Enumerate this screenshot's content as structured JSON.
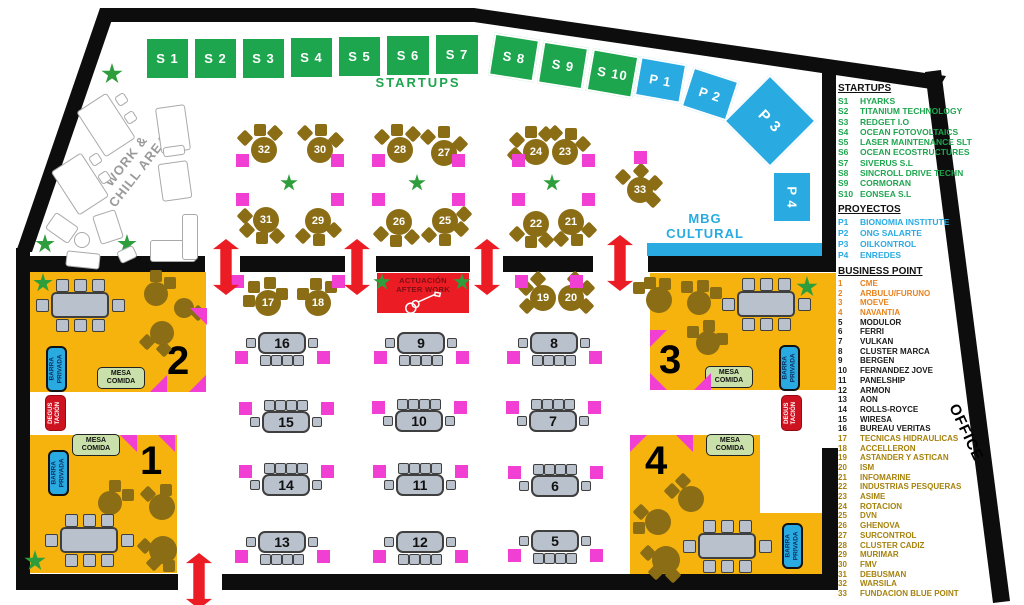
{
  "labels": {
    "startups_banner": "STARTUPS",
    "work_chill": "WORK &\nCHILL AREA",
    "mbg": "MBG\nCULTURAL",
    "office": "OFFICE",
    "stage": "ACTUACIÓN\nAFTER WORK",
    "barra": "BARRA\nPRIVADA",
    "mesa": "MESA\nCOMIDA",
    "degustacion": "DEGUS\nTACIÓN",
    "z1": "1",
    "z2": "2",
    "z3": "3",
    "z4": "4"
  },
  "colors": {
    "startup_green": "#1EA64F",
    "proyecto_blue": "#29ABE2",
    "zone_yellow": "#F6B30D",
    "marker_pink": "#F13FD3",
    "entrance_red": "#EC1C24",
    "table_brown": "#8A6D15",
    "table_gray": "#B9C1CC",
    "business_orange": "#E8821C",
    "business_olive": "#A6820C",
    "wall_black": "#0d0d0d"
  },
  "legend": {
    "startups": {
      "header": "STARTUPS",
      "items": [
        {
          "code": "S1",
          "name": "HYARKS",
          "c": "g"
        },
        {
          "code": "S2",
          "name": "TITANIUM TECHNOLOGY",
          "c": "g"
        },
        {
          "code": "S3",
          "name": "REDGET I.O",
          "c": "g"
        },
        {
          "code": "S4",
          "name": "OCEAN FOTOVOLTAICS",
          "c": "g"
        },
        {
          "code": "S5",
          "name": "LASER MAINTENANCE SLT",
          "c": "g"
        },
        {
          "code": "S6",
          "name": "OCEAN ECOSTRUCTURES",
          "c": "g"
        },
        {
          "code": "S7",
          "name": "SIVERUS S.L",
          "c": "g"
        },
        {
          "code": "S8",
          "name": "SINCROLL DRIVE TECHN",
          "c": "g"
        },
        {
          "code": "S9",
          "name": "CORMORAN",
          "c": "g"
        },
        {
          "code": "S10",
          "name": "EONSEA S.L",
          "c": "g"
        }
      ]
    },
    "proyectos": {
      "header": "PROYECTOS",
      "items": [
        {
          "code": "P1",
          "name": "BIONOMIA INSTITUTE",
          "c": "b"
        },
        {
          "code": "P2",
          "name": "ONG SALARTE",
          "c": "b"
        },
        {
          "code": "P3",
          "name": "OILKONTROL",
          "c": "b"
        },
        {
          "code": "P4",
          "name": "ENREDES",
          "c": "b"
        }
      ]
    },
    "business": {
      "header": "BUSINESS POINT",
      "items": [
        {
          "code": "1",
          "name": "CME",
          "c": "o"
        },
        {
          "code": "2",
          "name": "ARBULU/FURUNO",
          "c": "o"
        },
        {
          "code": "3",
          "name": "MOEVE",
          "c": "o"
        },
        {
          "code": "4",
          "name": "NAVANTIA",
          "c": "o"
        },
        {
          "code": "5",
          "name": "MODULOR",
          "c": "k"
        },
        {
          "code": "6",
          "name": "FERRI",
          "c": "k"
        },
        {
          "code": "7",
          "name": "VULKAN",
          "c": "k"
        },
        {
          "code": "8",
          "name": "CLUSTER MARCA",
          "c": "k"
        },
        {
          "code": "9",
          "name": "BERGEN",
          "c": "k"
        },
        {
          "code": "10",
          "name": "FERNANDEZ JOVE",
          "c": "k"
        },
        {
          "code": "11",
          "name": "PANELSHIP",
          "c": "k"
        },
        {
          "code": "12",
          "name": "ARMON",
          "c": "k"
        },
        {
          "code": "13",
          "name": "AON",
          "c": "k"
        },
        {
          "code": "14",
          "name": "ROLLS-ROYCE",
          "c": "k"
        },
        {
          "code": "15",
          "name": "WIRESA",
          "c": "k"
        },
        {
          "code": "16",
          "name": "BUREAU VERITAS",
          "c": "k"
        },
        {
          "code": "17",
          "name": "TECNICAS HIDRAULICAS",
          "c": "y"
        },
        {
          "code": "18",
          "name": "ACCELLERON",
          "c": "y"
        },
        {
          "code": "19",
          "name": "ASTANDER Y ASTICAN",
          "c": "y"
        },
        {
          "code": "20",
          "name": "ISM",
          "c": "y"
        },
        {
          "code": "21",
          "name": "INFOMARINE",
          "c": "y"
        },
        {
          "code": "22",
          "name": "INDUSTRIAS PESQUERAS",
          "c": "y"
        },
        {
          "code": "23",
          "name": "ASIME",
          "c": "y"
        },
        {
          "code": "24",
          "name": "ROTACION",
          "c": "y"
        },
        {
          "code": "25",
          "name": "DVN",
          "c": "y"
        },
        {
          "code": "26",
          "name": "GHENOVA",
          "c": "y"
        },
        {
          "code": "27",
          "name": "SURCONTROL",
          "c": "y"
        },
        {
          "code": "28",
          "name": "CLUSTER CADIZ",
          "c": "y"
        },
        {
          "code": "29",
          "name": "MURIMAR",
          "c": "y"
        },
        {
          "code": "30",
          "name": "FMV",
          "c": "y"
        },
        {
          "code": "31",
          "name": "DEBUSMAN",
          "c": "y"
        },
        {
          "code": "32",
          "name": "WARSILA",
          "c": "y"
        },
        {
          "code": "33",
          "name": "FUNDACION BLUE POINT",
          "c": "y"
        }
      ]
    }
  },
  "booths": {
    "startups": [
      {
        "label": "S 1",
        "x": 145,
        "y": 37,
        "w": 45,
        "h": 43,
        "rot": 0
      },
      {
        "label": "S 2",
        "x": 193,
        "y": 37,
        "w": 45,
        "h": 43,
        "rot": 0
      },
      {
        "label": "S 3",
        "x": 241,
        "y": 37,
        "w": 45,
        "h": 43,
        "rot": 0
      },
      {
        "label": "S 4",
        "x": 289,
        "y": 36,
        "w": 45,
        "h": 43,
        "rot": 0
      },
      {
        "label": "S 5",
        "x": 337,
        "y": 35,
        "w": 45,
        "h": 43,
        "rot": 0
      },
      {
        "label": "S 6",
        "x": 385,
        "y": 34,
        "w": 46,
        "h": 43,
        "rot": 0
      },
      {
        "label": "S 7",
        "x": 434,
        "y": 33,
        "w": 46,
        "h": 43,
        "rot": 0
      },
      {
        "label": "S 8",
        "x": 491,
        "y": 36,
        "w": 46,
        "h": 43,
        "rot": 9
      },
      {
        "label": "S 9",
        "x": 540,
        "y": 44,
        "w": 46,
        "h": 43,
        "rot": 9
      },
      {
        "label": "S 10",
        "x": 589,
        "y": 52,
        "w": 47,
        "h": 43,
        "rot": 10
      }
    ],
    "proyectos": [
      {
        "label": "P 1",
        "x": 637,
        "y": 60,
        "w": 47,
        "h": 40,
        "rot": 10
      },
      {
        "label": "P 2",
        "x": 686,
        "y": 73,
        "w": 48,
        "h": 42,
        "rot": 18
      },
      {
        "label": "P 3",
        "x": 737,
        "y": 88,
        "w": 66,
        "h": 66,
        "rot": 45,
        "fs": 15
      },
      {
        "label": "P 4",
        "x": 772,
        "y": 171,
        "w": 40,
        "h": 52,
        "rot": 0,
        "vert": true
      }
    ]
  },
  "round_tables": [
    {
      "n": "32",
      "x": 264,
      "y": 150,
      "ch": [
        [
          -19,
          -12,
          45
        ],
        [
          -4,
          -20,
          0
        ],
        [
          11,
          -17,
          45
        ]
      ]
    },
    {
      "n": "30",
      "x": 320,
      "y": 150,
      "ch": [
        [
          -15,
          -17,
          45
        ],
        [
          1,
          -20,
          0
        ],
        [
          16,
          -10,
          45
        ]
      ]
    },
    {
      "n": "28",
      "x": 400,
      "y": 150,
      "ch": [
        [
          -18,
          -13,
          45
        ],
        [
          -3,
          -20,
          0
        ],
        [
          13,
          -16,
          45
        ]
      ]
    },
    {
      "n": "27",
      "x": 444,
      "y": 153,
      "ch": [
        [
          -16,
          -16,
          45
        ],
        [
          0,
          -21,
          0
        ],
        [
          16,
          -9,
          45
        ]
      ]
    },
    {
      "n": "24",
      "x": 536,
      "y": 152,
      "ch": [
        [
          -19,
          -12,
          45
        ],
        [
          -5,
          -20,
          0
        ],
        [
          10,
          -18,
          45
        ],
        [
          -21,
          3,
          45
        ]
      ]
    },
    {
      "n": "23",
      "x": 565,
      "y": 152,
      "ch": [
        [
          -10,
          -19,
          45
        ],
        [
          6,
          -18,
          0
        ],
        [
          18,
          -8,
          45
        ]
      ]
    },
    {
      "n": "31",
      "x": 266,
      "y": 220,
      "ch": [
        [
          -19,
          10,
          45
        ],
        [
          -4,
          18,
          0
        ],
        [
          11,
          16,
          45
        ],
        [
          -21,
          -4,
          45
        ]
      ]
    },
    {
      "n": "29",
      "x": 318,
      "y": 221,
      "ch": [
        [
          -15,
          15,
          45
        ],
        [
          1,
          19,
          0
        ],
        [
          16,
          9,
          45
        ]
      ]
    },
    {
      "n": "26",
      "x": 399,
      "y": 222,
      "ch": [
        [
          -18,
          12,
          45
        ],
        [
          -3,
          19,
          0
        ],
        [
          13,
          15,
          45
        ]
      ]
    },
    {
      "n": "25",
      "x": 445,
      "y": 221,
      "ch": [
        [
          -16,
          14,
          45
        ],
        [
          0,
          19,
          0
        ],
        [
          16,
          8,
          45
        ],
        [
          19,
          -7,
          45
        ]
      ]
    },
    {
      "n": "22",
      "x": 536,
      "y": 224,
      "ch": [
        [
          -19,
          10,
          45
        ],
        [
          -5,
          18,
          0
        ],
        [
          10,
          16,
          45
        ]
      ]
    },
    {
      "n": "21",
      "x": 571,
      "y": 222,
      "ch": [
        [
          -10,
          17,
          45
        ],
        [
          6,
          18,
          0
        ],
        [
          18,
          8,
          45
        ]
      ]
    },
    {
      "n": "33",
      "x": 640,
      "y": 190,
      "ch": [
        [
          -17,
          -13,
          45
        ],
        [
          1,
          -19,
          45
        ],
        [
          15,
          -7,
          45
        ],
        [
          13,
          10,
          45
        ]
      ]
    },
    {
      "n": "17",
      "x": 268,
      "y": 303,
      "ch": [
        [
          -14,
          -16,
          0
        ],
        [
          2,
          -20,
          0
        ],
        [
          -19,
          -2,
          0
        ],
        [
          14,
          -9,
          0
        ]
      ]
    },
    {
      "n": "18",
      "x": 318,
      "y": 303,
      "ch": [
        [
          -15,
          -9,
          0
        ],
        [
          -2,
          -19,
          0
        ],
        [
          13,
          -16,
          0
        ]
      ]
    },
    {
      "n": "19",
      "x": 543,
      "y": 298,
      "ch": [
        [
          -17,
          -10,
          45
        ],
        [
          -5,
          -19,
          45
        ],
        [
          -16,
          8,
          45
        ]
      ]
    },
    {
      "n": "20",
      "x": 571,
      "y": 298,
      "ch": [
        [
          16,
          -10,
          45
        ],
        [
          4,
          -19,
          45
        ],
        [
          15,
          8,
          45
        ]
      ]
    }
  ],
  "rect_tables": [
    {
      "n": "16",
      "x": 282,
      "y": 343,
      "side": "bottom"
    },
    {
      "n": "9",
      "x": 421,
      "y": 343,
      "side": "bottom"
    },
    {
      "n": "8",
      "x": 554,
      "y": 343,
      "side": "bottom"
    },
    {
      "n": "15",
      "x": 286,
      "y": 422,
      "side": "top"
    },
    {
      "n": "10",
      "x": 419,
      "y": 421,
      "side": "top"
    },
    {
      "n": "7",
      "x": 553,
      "y": 421,
      "side": "top"
    },
    {
      "n": "14",
      "x": 286,
      "y": 485,
      "side": "top"
    },
    {
      "n": "11",
      "x": 420,
      "y": 485,
      "side": "top"
    },
    {
      "n": "6",
      "x": 555,
      "y": 486,
      "side": "top"
    },
    {
      "n": "13",
      "x": 282,
      "y": 542,
      "side": "bottom"
    },
    {
      "n": "12",
      "x": 420,
      "y": 542,
      "side": "bottom"
    },
    {
      "n": "5",
      "x": 555,
      "y": 541,
      "side": "bottom"
    }
  ],
  "zone_round_tables": [
    {
      "x": 156,
      "y": 294,
      "d": 24,
      "ch": [
        [
          14,
          -11,
          0
        ],
        [
          0,
          -18,
          0
        ]
      ]
    },
    {
      "x": 184,
      "y": 308,
      "d": 20,
      "ch": [
        [
          14,
          5,
          45
        ]
      ]
    },
    {
      "x": 162,
      "y": 333,
      "d": 24,
      "ch": [
        [
          -15,
          9,
          45
        ],
        [
          2,
          16,
          45
        ]
      ]
    },
    {
      "x": 110,
      "y": 503,
      "d": 24,
      "ch": [
        [
          5,
          -17,
          0
        ],
        [
          18,
          -8,
          0
        ]
      ]
    },
    {
      "x": 162,
      "y": 507,
      "d": 26,
      "ch": [
        [
          -14,
          -13,
          45
        ],
        [
          4,
          -17,
          0
        ]
      ]
    },
    {
      "x": 163,
      "y": 550,
      "d": 28,
      "ch": [
        [
          -18,
          -4,
          45
        ],
        [
          -9,
          13,
          45
        ],
        [
          6,
          16,
          0
        ]
      ]
    },
    {
      "x": 659,
      "y": 300,
      "d": 26,
      "ch": [
        [
          -9,
          -17,
          0
        ],
        [
          6,
          -16,
          0
        ],
        [
          -20,
          -12,
          0
        ]
      ]
    },
    {
      "x": 699,
      "y": 303,
      "d": 24,
      "ch": [
        [
          -12,
          -16,
          0
        ],
        [
          4,
          -17,
          0
        ],
        [
          17,
          -10,
          0
        ]
      ]
    },
    {
      "x": 708,
      "y": 343,
      "d": 24,
      "ch": [
        [
          -15,
          -11,
          0
        ],
        [
          1,
          -17,
          0
        ],
        [
          14,
          -4,
          0
        ]
      ]
    },
    {
      "x": 691,
      "y": 499,
      "d": 26,
      "ch": [
        [
          -8,
          -18,
          45
        ],
        [
          -19,
          -8,
          45
        ]
      ]
    },
    {
      "x": 658,
      "y": 522,
      "d": 26,
      "ch": [
        [
          -17,
          -10,
          45
        ],
        [
          -19,
          6,
          0
        ]
      ]
    },
    {
      "x": 666,
      "y": 560,
      "d": 28,
      "ch": [
        [
          -18,
          -7,
          45
        ],
        [
          -10,
          12,
          45
        ],
        [
          7,
          15,
          45
        ]
      ]
    }
  ],
  "zone_rect_tables": [
    {
      "x": 80,
      "y": 305
    },
    {
      "x": 89,
      "y": 540
    },
    {
      "x": 766,
      "y": 304
    },
    {
      "x": 727,
      "y": 546
    }
  ],
  "pink_squares": [
    [
      242,
      160
    ],
    [
      337,
      160
    ],
    [
      242,
      199
    ],
    [
      337,
      199
    ],
    [
      378,
      160
    ],
    [
      458,
      160
    ],
    [
      378,
      199
    ],
    [
      458,
      199
    ],
    [
      518,
      160
    ],
    [
      588,
      160
    ],
    [
      518,
      199
    ],
    [
      588,
      199
    ],
    [
      640,
      157
    ],
    [
      237,
      281
    ],
    [
      338,
      281
    ],
    [
      521,
      281
    ],
    [
      576,
      281
    ]
  ],
  "pink_triangles": [
    {
      "x": 190,
      "y": 308,
      "t": "tr"
    },
    {
      "x": 150,
      "y": 375,
      "t": "br"
    },
    {
      "x": 189,
      "y": 375,
      "t": "br"
    },
    {
      "x": 120,
      "y": 435,
      "t": "tr"
    },
    {
      "x": 158,
      "y": 435,
      "t": "tr"
    },
    {
      "x": 650,
      "y": 330,
      "t": "tl"
    },
    {
      "x": 650,
      "y": 373,
      "t": "bl"
    },
    {
      "x": 694,
      "y": 373,
      "t": "br"
    },
    {
      "x": 630,
      "y": 435,
      "t": "tl"
    },
    {
      "x": 676,
      "y": 435,
      "t": "tr"
    }
  ],
  "plants": [
    [
      112,
      74,
      22
    ],
    [
      72,
      170,
      22
    ],
    [
      45,
      244,
      20
    ],
    [
      127,
      244,
      20
    ],
    [
      289,
      183,
      18
    ],
    [
      417,
      183,
      18
    ],
    [
      552,
      183,
      18
    ],
    [
      382,
      282,
      18
    ],
    [
      462,
      282,
      18
    ],
    [
      43,
      283,
      20
    ],
    [
      807,
      287,
      22
    ],
    [
      35,
      561,
      22
    ]
  ],
  "entrance_arrows": [
    [
      226,
      267
    ],
    [
      357,
      267
    ],
    [
      487,
      267
    ],
    [
      620,
      263
    ],
    [
      199,
      581
    ]
  ],
  "work_furniture": [
    [
      88,
      98,
      36,
      54,
      -33,
      0
    ],
    [
      62,
      158,
      36,
      52,
      -33,
      0
    ],
    [
      116,
      94,
      11,
      11,
      -33,
      0
    ],
    [
      125,
      112,
      11,
      11,
      -33,
      0
    ],
    [
      90,
      154,
      11,
      11,
      -33,
      0
    ],
    [
      99,
      172,
      11,
      11,
      -33,
      0
    ],
    [
      158,
      106,
      30,
      46,
      -8,
      0
    ],
    [
      160,
      162,
      30,
      38,
      -8,
      0
    ],
    [
      163,
      146,
      22,
      10,
      -8,
      0
    ],
    [
      48,
      218,
      28,
      20,
      35,
      0
    ],
    [
      96,
      212,
      24,
      30,
      -18,
      0
    ],
    [
      74,
      232,
      16,
      16,
      0,
      1
    ],
    [
      66,
      252,
      34,
      16,
      6,
      0
    ],
    [
      118,
      248,
      18,
      13,
      -25,
      0
    ],
    [
      150,
      240,
      46,
      22,
      0,
      0
    ],
    [
      182,
      214,
      16,
      46,
      0,
      0
    ]
  ]
}
